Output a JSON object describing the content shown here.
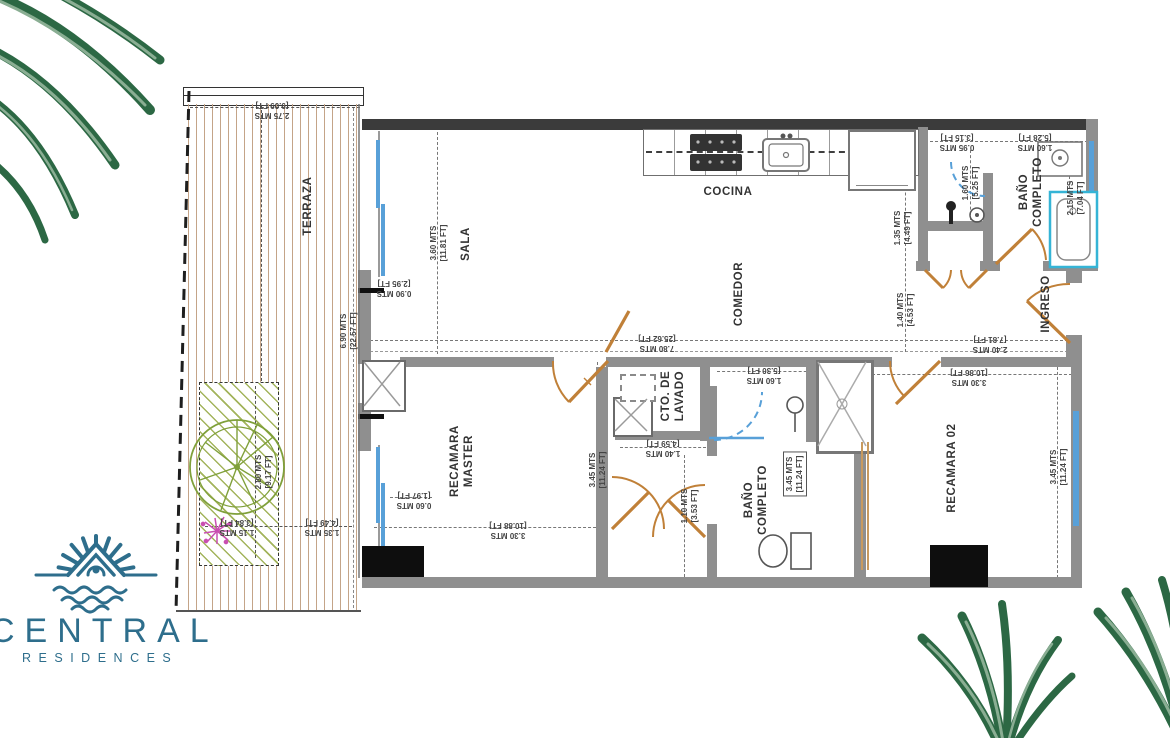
{
  "colors": {
    "wall": "#8f8f8f",
    "wallDark": "#3b3b3b",
    "door": "#c08038",
    "window": "#58a0d8",
    "tub": "#35b4d6",
    "teal": "#2e6e8c",
    "leafDark": "#2c6844",
    "leafLight": "#8aae93",
    "deck": "#c4a488",
    "garden": "#a3b45c",
    "tree": "#7fa03a",
    "plant": "#c94fb0",
    "ink": "#3a3a3a"
  },
  "logo": {
    "title": "CENTRAL",
    "subtitle": "RESIDENCES"
  },
  "rooms": {
    "terraza": "TERRAZA",
    "sala": "SALA",
    "cocina": "COCINA",
    "comedor": "COMEDOR",
    "bano_planta_alta": "BAÑO\nCOMPLETO",
    "ingreso": "INGRESO",
    "recamara_master": "RECAMARA\nMASTER",
    "cto_lavado": "CTO. DE\nLAVADO",
    "bano_completo": "BAÑO\nCOMPLETO",
    "recamara_02": "RECAMARA 02"
  },
  "dims": {
    "d1": "2.75 MTS\n[9.09 FT]",
    "d2": "0.90 MTS\n[2.95 FT]",
    "d3": "3.60 MTS\n[11.81 FT]",
    "d4": "6.90 MTS\n[22.57 FT]",
    "d5": "7.80 MTS\n[25.62 FT]",
    "d6": "0.95 MTS\n[3.15 FT]",
    "d7": "1.60 MTS\n[5.28 FT]",
    "d8": "1.60 MTS\n[5.25 FT]",
    "d9": "2.15 MTS\n[7.04 FT]",
    "d10": "1.35 MTS\n[4.49 FT]",
    "d11": "1.40 MTS\n[4.53 FT]",
    "d12": "2.40 MTS\n[7.81 FT]",
    "d13": "3.30 MTS\n[10.86 FT]",
    "d14": "3.45 MTS\n[11.24 FT]",
    "d15": "1.60 MTS\n[5.30 FT]",
    "d16": "3.45 MTS\n[11.24 FT]",
    "d17": "1.40 MTS\n[4.59 FT]",
    "d18": "1.10 MTS\n[3.53 FT]",
    "d19": "3.45 MTS\n[11.24 FT]",
    "d20": "3.30 MTS\n[10.88 FT]",
    "d21": "0.60 MTS\n[1.97 FT]",
    "d22": "2.80 MTS\n[9.17 FT]",
    "d23": "1.35 MTS\n[4.49 FT]",
    "d24": "1.15 MTS\n[3.84 FT]"
  }
}
